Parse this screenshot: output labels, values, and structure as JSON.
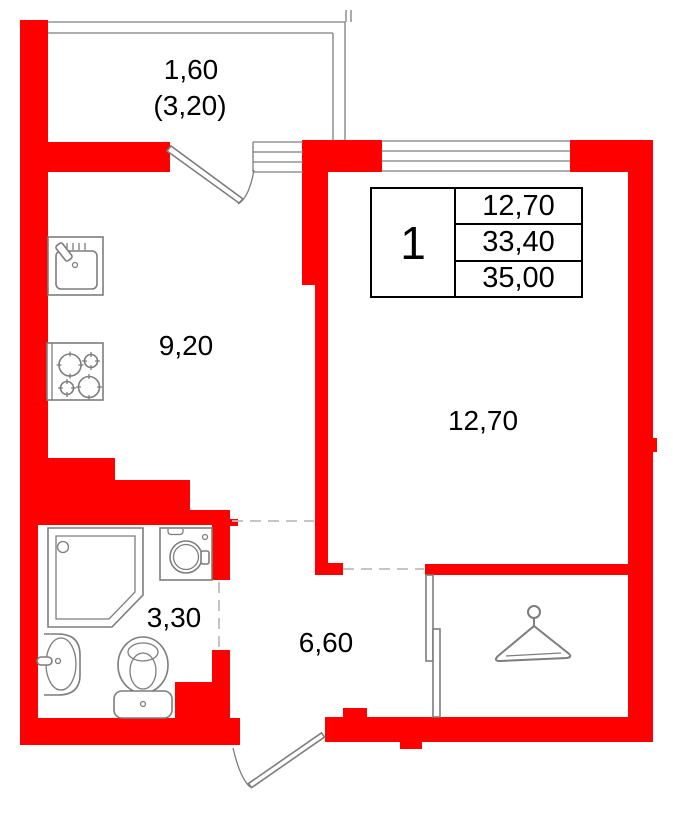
{
  "colors": {
    "wall": "#ff0000",
    "line": "#7d7d7d",
    "dash": "#bdbdbd",
    "text": "#000000",
    "background": "#ffffff"
  },
  "rooms": {
    "balcony": {
      "area": "1,60",
      "area_full": "(3,20)"
    },
    "kitchen": {
      "area": "9,20"
    },
    "living_room": {
      "area": "12,70"
    },
    "bathroom": {
      "area": "3,30"
    },
    "hallway": {
      "area": "6,60"
    }
  },
  "info_table": {
    "rooms_count": "1",
    "living_area": "12,70",
    "living_space": "33,40",
    "total_area": "35,00"
  },
  "icons": [
    "kitchen-sink-icon",
    "stove-icon",
    "shower-cabin-icon",
    "washing-machine-icon",
    "washbasin-icon",
    "toilet-icon",
    "clothes-hanger-icon",
    "balcony-door-icon",
    "entrance-door-icon",
    "sliding-door-icon",
    "window-icon",
    "balcony-railing-icon"
  ]
}
